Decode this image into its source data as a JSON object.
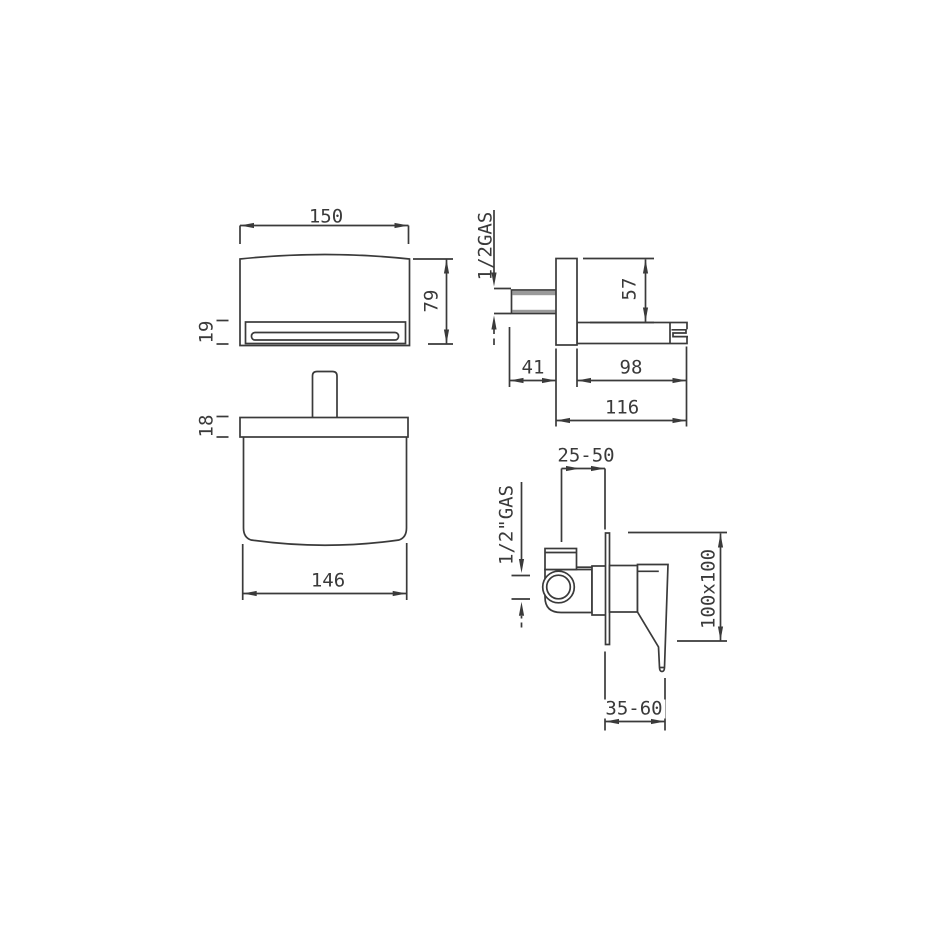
{
  "page": {
    "background": "#ffffff",
    "line_color": "#3a3a3a",
    "thread_color": "#9a9a9a",
    "title": "Wall-mounted waterfall spout and concealed mixer installation drawing"
  },
  "views": {
    "spout_front": {
      "dim_width": "150",
      "dim_height": "79",
      "dim_slot": "19"
    },
    "spout_side": {
      "dim_thread": "1/2GAS",
      "dim_plate_to_spout": "57",
      "dim_wall_to_plate": "41",
      "dim_spout_length": "98",
      "dim_total_projection": "116"
    },
    "spout_top": {
      "dim_plate_depth": "18",
      "dim_body_width": "146"
    },
    "mixer_side": {
      "dim_depth_range": "25-50",
      "dim_thread": "1/2\"GAS",
      "dim_plate_size": "100x100",
      "dim_handle_range": "35-60"
    }
  }
}
